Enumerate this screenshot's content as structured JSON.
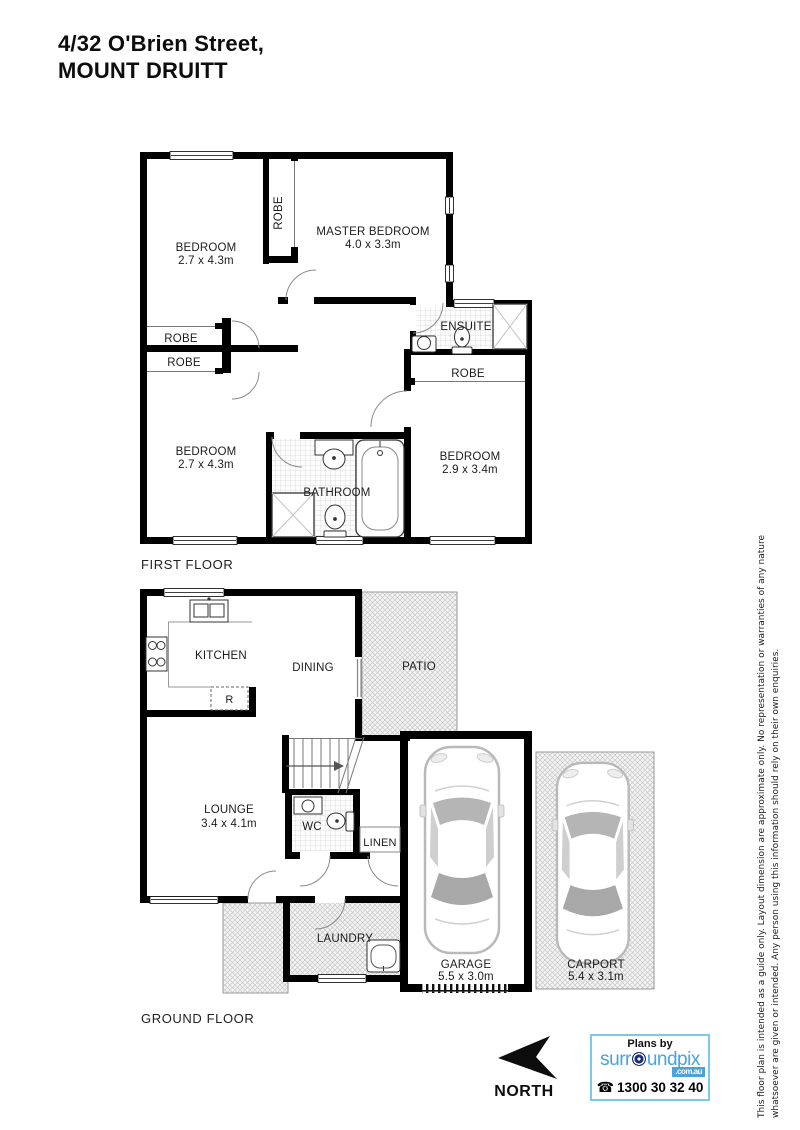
{
  "title": {
    "line1": "4/32 O'Brien Street,",
    "line2": "MOUNT DRUITT"
  },
  "first_floor": {
    "label": "FIRST FLOOR",
    "bedroom_top_left": {
      "name": "BEDROOM",
      "dims": "2.7 x 4.3m"
    },
    "robe_column": "ROBE",
    "master_bedroom": {
      "name": "MASTER BEDROOM",
      "dims": "4.0 x 3.3m"
    },
    "ensuite": "ENSUITE",
    "robe_left_upper": "ROBE",
    "robe_left_lower": "ROBE",
    "robe_right": "ROBE",
    "bedroom_bottom_left": {
      "name": "BEDROOM",
      "dims": "2.7 x 4.3m"
    },
    "bathroom": "BATHROOM",
    "bedroom_bottom_right": {
      "name": "BEDROOM",
      "dims": "2.9 x 3.4m"
    }
  },
  "ground_floor": {
    "label": "GROUND FLOOR",
    "kitchen": "KITCHEN",
    "fridge": "R",
    "dining": "DINING",
    "patio": "PATIO",
    "lounge": {
      "name": "LOUNGE",
      "dims": "3.4 x 4.1m"
    },
    "wc": "WC",
    "linen": "LINEN",
    "laundry": "LAUNDRY",
    "garage": {
      "name": "GARAGE",
      "dims": "5.5 x 3.0m"
    },
    "carport": {
      "name": "CARPORT",
      "dims": "5.4 x 3.1m"
    }
  },
  "compass": {
    "label": "NORTH"
  },
  "branding": {
    "plans_by": "Plans by",
    "name_pre": "surr",
    "name_post": "undpix",
    "domain": ".com.au",
    "phone_icon": "☎",
    "phone": "1300 30 32 40"
  },
  "disclaimer": {
    "line1": "This floor plan is intended as a guide only. Layout dimension are approximate only. No representation or warranties of any nature",
    "line2": "whatsoever are given or intended. Any person using this information should rely on their own enquiries."
  }
}
